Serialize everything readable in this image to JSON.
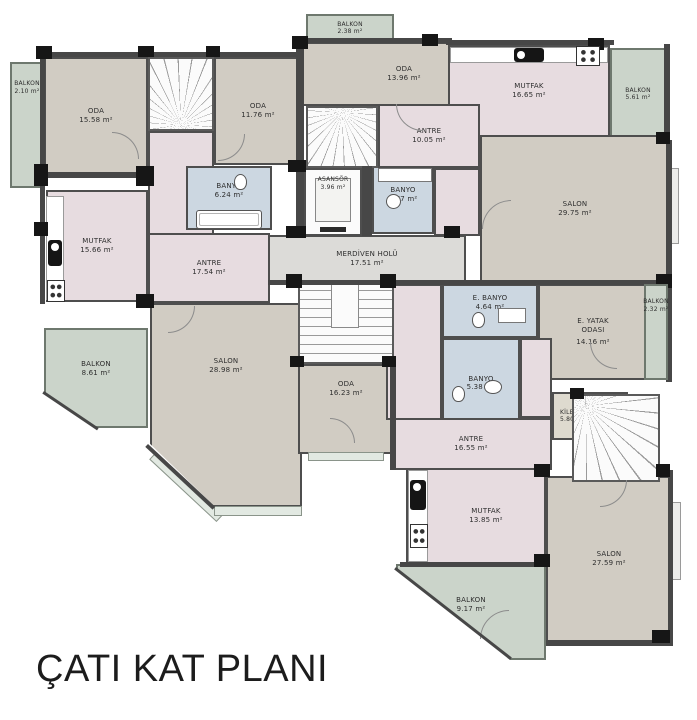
{
  "title": "ÇATI KAT PLANI",
  "rooms": {
    "balkon_top_left": {
      "name": "BALKON",
      "area": "2.10 m²"
    },
    "oda_top_left": {
      "name": "ODA",
      "area": "15.58 m²"
    },
    "oda_top_mid": {
      "name": "ODA",
      "area": "11.76 m²"
    },
    "balkon_top_center": {
      "name": "BALKON",
      "area": "2.38 m²"
    },
    "oda_top_center": {
      "name": "ODA",
      "area": "13.96 m²"
    },
    "mutfak_top_right": {
      "name": "MUTFAK",
      "area": "16.65 m²"
    },
    "balkon_top_right": {
      "name": "BALKON",
      "area": "5.61 m²"
    },
    "antre_top": {
      "name": "ANTRE",
      "area": "10.05 m²"
    },
    "banyo_top_left": {
      "name": "BANYO",
      "area": "6.24 m²"
    },
    "asansor": {
      "name": "ASANSÖR",
      "area": "3.96 m²"
    },
    "banyo_top_right": {
      "name": "BANYO",
      "area": "3.77 m²"
    },
    "salon_top_right": {
      "name": "SALON",
      "area": "29.75 m²"
    },
    "merdiven_holu": {
      "name": "MERDİVEN HOLÜ",
      "area": "17.51 m²"
    },
    "mutfak_left": {
      "name": "MUTFAK",
      "area": "15.66 m²"
    },
    "antre_left": {
      "name": "ANTRE",
      "area": "17.54 m²"
    },
    "balkon_left": {
      "name": "BALKON",
      "area": "8.61 m²"
    },
    "salon_left": {
      "name": "SALON",
      "area": "28.98 m²"
    },
    "oda_center": {
      "name": "ODA",
      "area": "16.23 m²"
    },
    "e_banyo": {
      "name": "E. BANYO",
      "area": "4.64 m²"
    },
    "e_yatak": {
      "name": "E. YATAK ODASI",
      "area": "14.16 m²"
    },
    "balkon_right": {
      "name": "BALKON",
      "area": "2.32 m²"
    },
    "banyo_bottom": {
      "name": "BANYO",
      "area": "5.38 m²"
    },
    "kiler": {
      "name": "KİLER",
      "area": "5.80 m²"
    },
    "antre_bottom": {
      "name": "ANTRE",
      "area": "16.55 m²"
    },
    "mutfak_bottom": {
      "name": "MUTFAK",
      "area": "13.85 m²"
    },
    "salon_bottom": {
      "name": "SALON",
      "area": "27.59 m²"
    },
    "balkon_bottom": {
      "name": "BALKON",
      "area": "9.17 m²"
    }
  },
  "colors": {
    "room_beige": "#d1ccc3",
    "service_pink": "#e7dce0",
    "bath_blue": "#ccd7e1",
    "balcony_green": "#cbd4ca",
    "hall_gray": "#dcdbd8",
    "wall_dark": "#474747",
    "column_black": "#161616"
  }
}
